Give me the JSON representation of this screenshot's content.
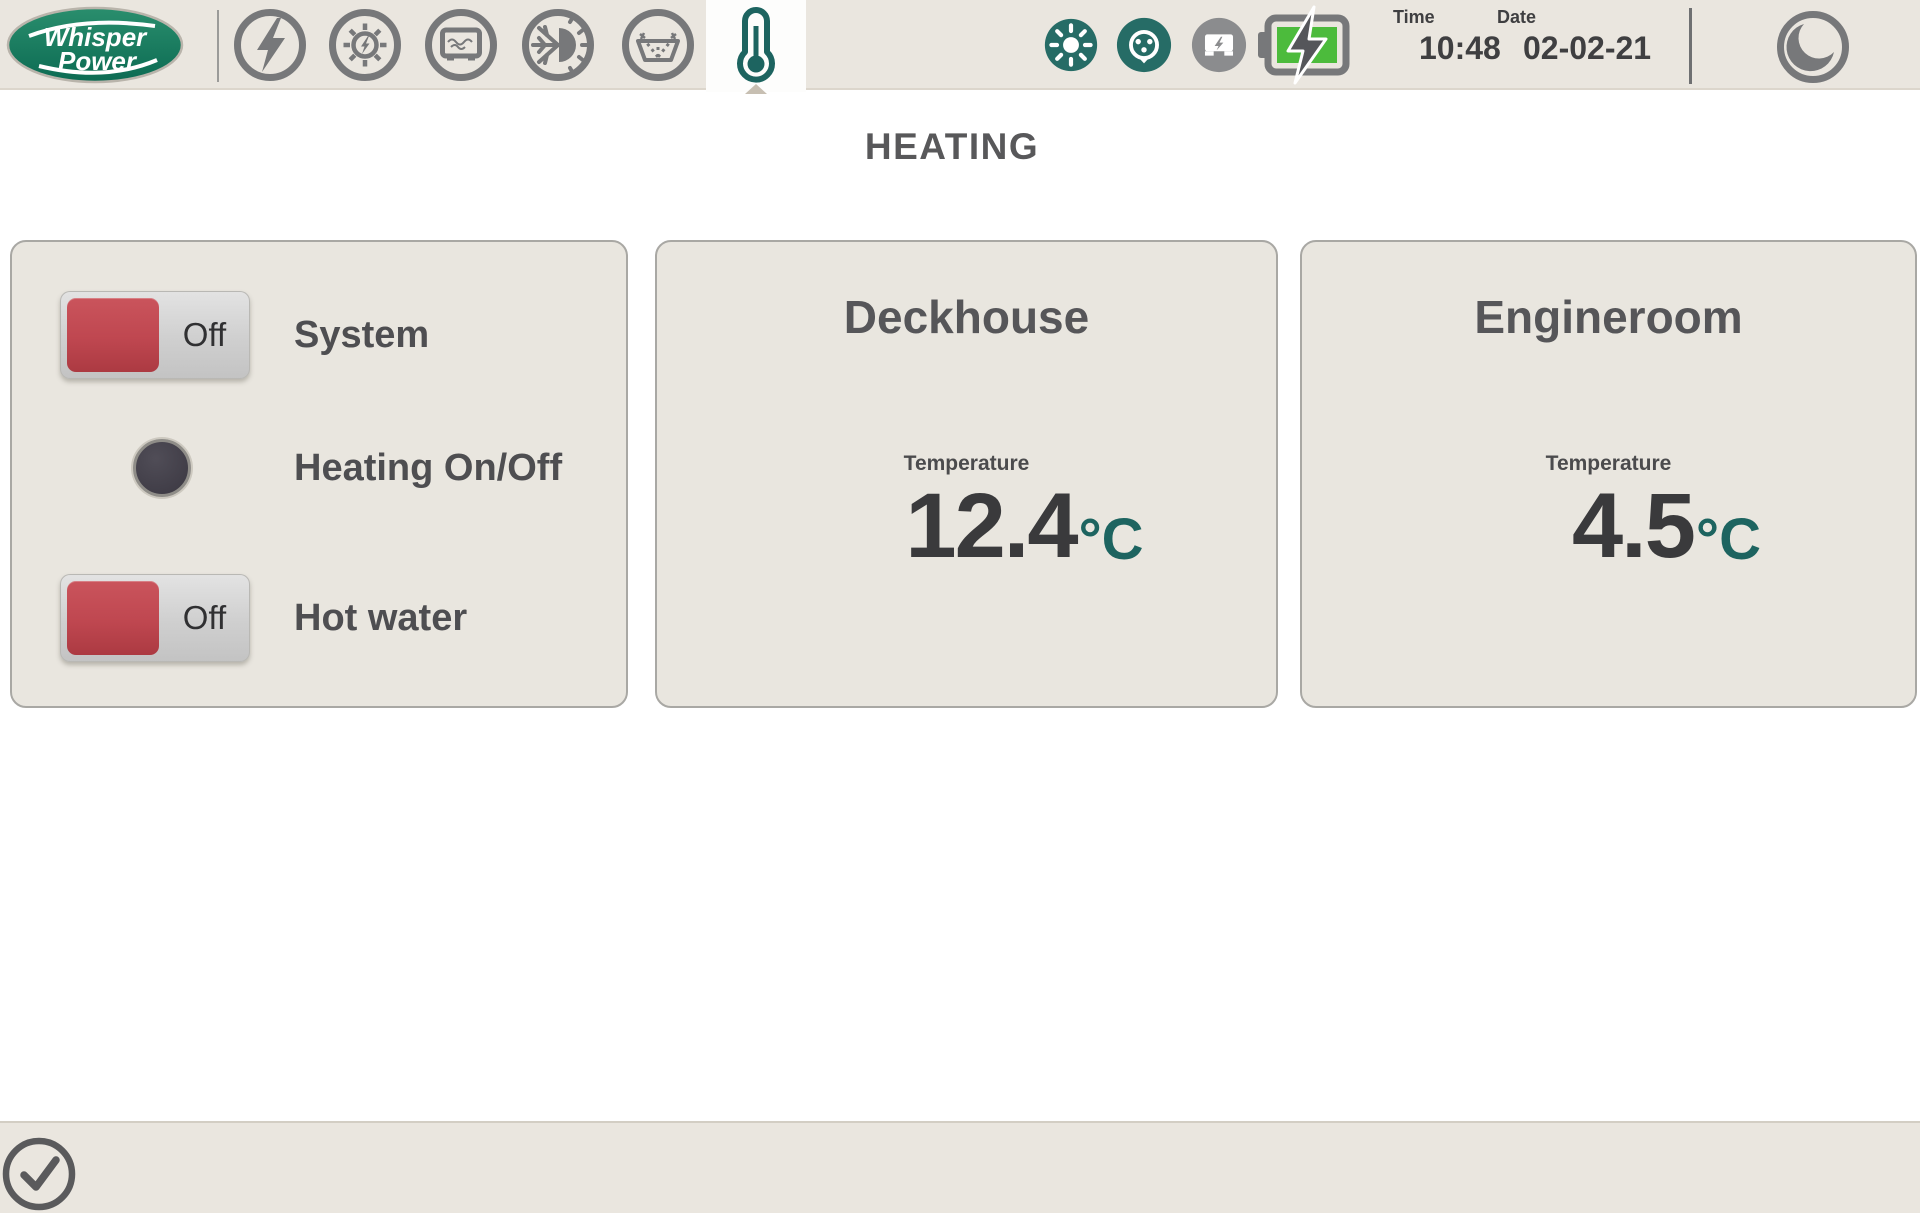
{
  "colors": {
    "bar-bg": "#eae6df",
    "panel-bg": "#e9e6df",
    "panel-border": "#a9a8a4",
    "teal": "#1d6460",
    "status-teal": "#266c66",
    "icon-gray": "#77787a",
    "text-dark": "#4e4e51",
    "title-gray": "#58585a",
    "knob-red": "#bf4750",
    "battery-green": "#4cbb3c",
    "inverter-gray": "#8b8c8e"
  },
  "brand": {
    "name_line1": "Whisper",
    "name_line2": "Power"
  },
  "topbar": {
    "nav_icons": [
      "lightning-bolt",
      "solar-sun",
      "generator-box",
      "climate-snowflake-sun",
      "windshield-washer",
      "thermometer-selected"
    ],
    "status_icons": [
      "solar-active",
      "shore-power-active",
      "inverter-inactive",
      "battery-charging"
    ],
    "clock": {
      "time_label": "Time",
      "time_value": "10:48",
      "date_label": "Date",
      "date_value": "02-02-21"
    },
    "night_mode_icon": "moon"
  },
  "page": {
    "title": "HEATING"
  },
  "controls": {
    "system": {
      "label": "System",
      "state": "Off"
    },
    "heating_toggle": {
      "label": "Heating On/Off"
    },
    "hot_water": {
      "label": "Hot water",
      "state": "Off"
    }
  },
  "zones": [
    {
      "name": "Deckhouse",
      "measure_label": "Temperature",
      "value": "12.4",
      "unit": "°C"
    },
    {
      "name": "Engineroom",
      "measure_label": "Temperature",
      "value": "4.5",
      "unit": "°C"
    }
  ],
  "footer": {
    "confirm_icon": "check-circle"
  }
}
